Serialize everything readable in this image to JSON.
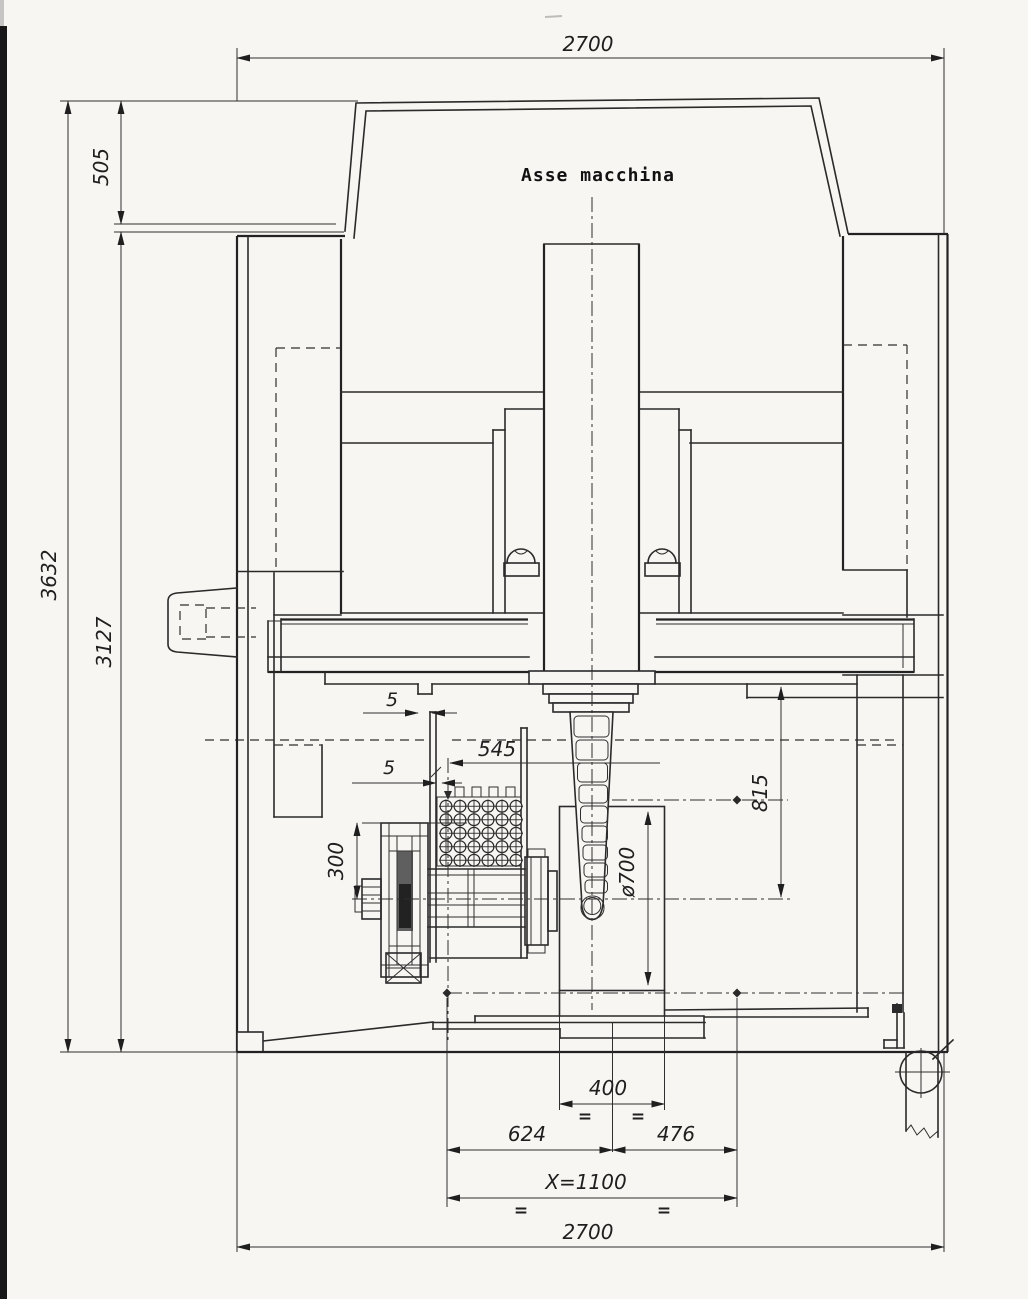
{
  "drawing": {
    "title": "Asse macchina",
    "dims": {
      "overall_width_top": "2700",
      "head_height": "505",
      "overall_height": "3632",
      "body_height": "3127",
      "gap_left": "5",
      "gap_plate": "5",
      "plate_to_axis": "545",
      "fixture_half_height": "300",
      "workpiece_dia": "ø700",
      "axis_offset": "815",
      "table_width": "400",
      "dist_left": "624",
      "dist_right": "476",
      "x_stroke": "X=1100",
      "overall_width_bottom": "2700",
      "eq": "="
    }
  }
}
